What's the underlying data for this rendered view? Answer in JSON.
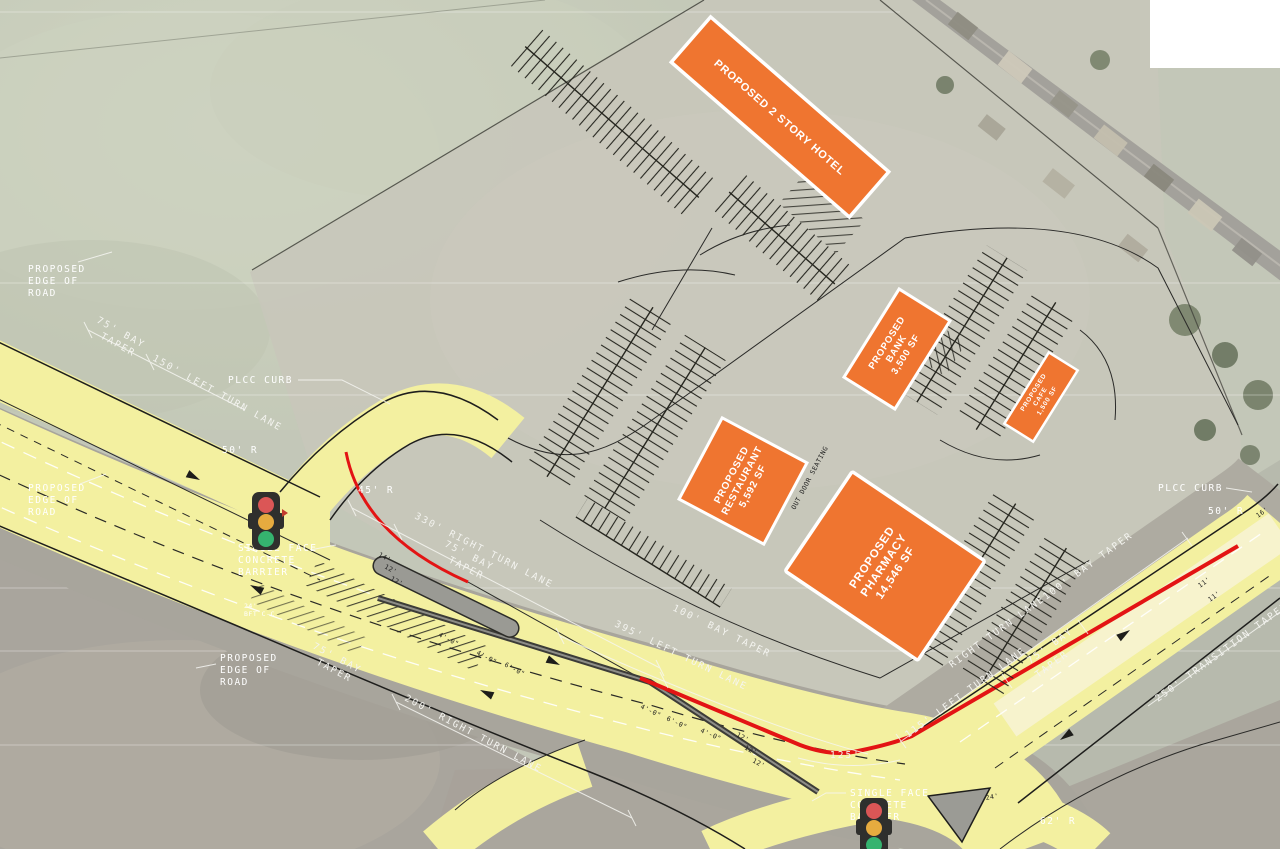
{
  "colors": {
    "building_fill": "#ef7530",
    "road_highlight": "#f3f0a0",
    "red_edge": "#e31414",
    "aerial_green": "#c6cabb",
    "aerial_gray": "#a9a59d",
    "signal_red": "#db5656",
    "signal_yellow": "#e6ab3f",
    "signal_green": "#35b36f"
  },
  "buildings": {
    "hotel": {
      "label": "PROPOSED 2 STORY HOTEL"
    },
    "bank": {
      "l1": "PROPOSED",
      "l2": "BANK",
      "l3": "3,500 SF"
    },
    "cafe": {
      "l1": "PROPOSED",
      "l2": "CAFE",
      "l3": "1,500 SF"
    },
    "restaurant": {
      "l1": "PROPOSED",
      "l2": "RESTAURANT",
      "l3": "5,592 SF"
    },
    "pharmacy": {
      "l1": "PROPOSED",
      "l2": "PHARMACY",
      "l3": "14,546 SF"
    }
  },
  "callouts": {
    "edge_of_road": {
      "l1": "PROPOSED",
      "l2": "EDGE OF",
      "l3": "ROAD"
    },
    "plcc_curb": "PLCC CURB",
    "barrier": {
      "l1": "SINGLE FACE",
      "l2": "CONCRETE",
      "l3": "BARRIER"
    },
    "outdoor_seating": "OUT DOOR SEATING",
    "bft": {
      "l1": "24'",
      "l2": "BFT C-C"
    }
  },
  "radii": {
    "r45": "45' R",
    "r50": "50' R",
    "r62": "62' R"
  },
  "dims": {
    "rt330": "330' RIGHT TURN LANE",
    "lt395": "395' LEFT TURN LANE",
    "rt200": "200' RIGHT TURN LANE",
    "lt150": "150' LEFT TURN LANE",
    "lt115": "115' LEFT TURN LANE",
    "rt_lane": "RIGHT TURN LANE",
    "tt250": "250' TRANSITION TAPER",
    "bay100": "100' BAY TAPER",
    "bay75_1": "75' BAY",
    "bay75_2": "TAPER",
    "d125": "125'"
  },
  "widths": {
    "w11": "11'",
    "w12": "12'",
    "w14": "14'",
    "w16": "16'",
    "w24": "24'",
    "w4": "4'-0\"",
    "w6": "6'-0\""
  }
}
